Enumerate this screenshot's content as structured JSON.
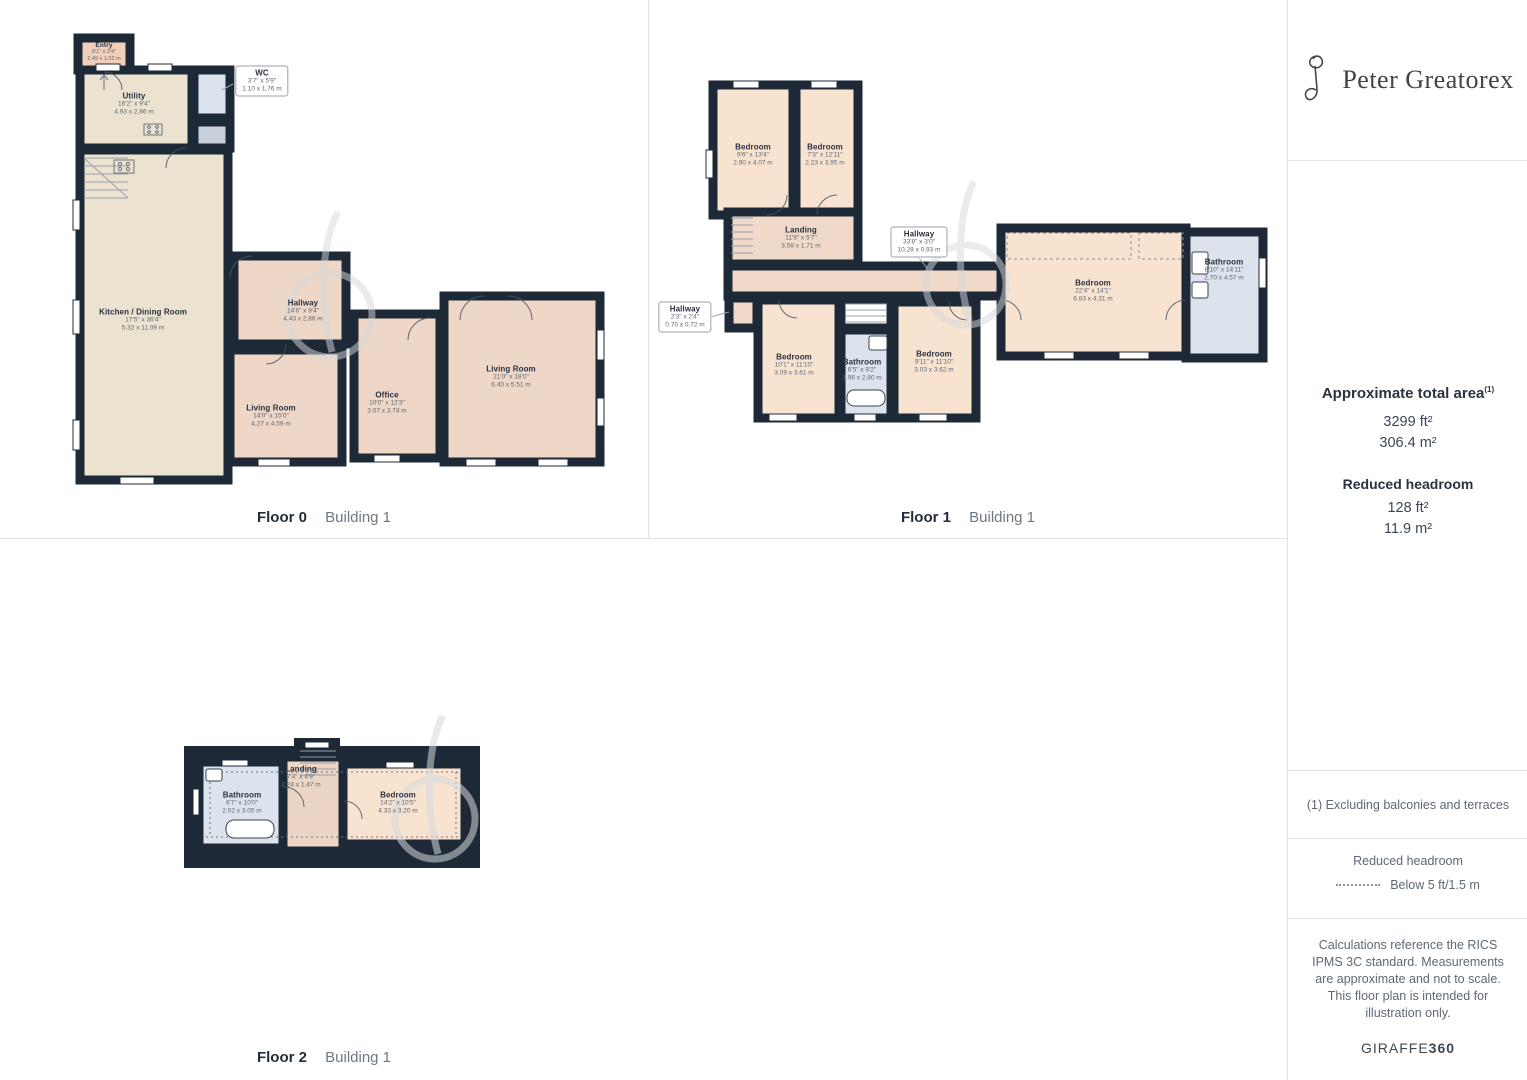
{
  "brand": {
    "name": "Peter Greatorex",
    "monogram": "PG"
  },
  "floors": [
    {
      "label": "Floor 0",
      "building": "Building 1",
      "rooms": [
        {
          "name": "Entry",
          "ft": "8'1\" x 3'4\"",
          "m": "2.49 x 1.02 m"
        },
        {
          "name": "Utility",
          "ft": "16'2\" x 9'4\"",
          "m": "4.93 x 2.86 m"
        },
        {
          "name": "WC",
          "ft": "3'7\" x 5'9\"",
          "m": "1.10 x 1.76 m"
        },
        {
          "name": "Kitchen / Dining Room",
          "ft": "17'5\" x 36'4\"",
          "m": "5.32 x 11.09 m"
        },
        {
          "name": "Hallway",
          "ft": "14'6\" x 9'4\"",
          "m": "4.43 x 2.86 m"
        },
        {
          "name": "Living Room",
          "ft": "14'0\" x 15'0\"",
          "m": "4.27 x 4.59 m"
        },
        {
          "name": "Office",
          "ft": "10'0\" x 12'3\"",
          "m": "3.07 x 3.74 m"
        },
        {
          "name": "Living Room",
          "ft": "21'0\" x 18'0\"",
          "m": "6.40 x 5.51 m"
        }
      ]
    },
    {
      "label": "Floor 1",
      "building": "Building 1",
      "rooms": [
        {
          "name": "Bedroom",
          "ft": "9'6\" x 13'4\"",
          "m": "2.90 x 4.07 m"
        },
        {
          "name": "Bedroom",
          "ft": "7'3\" x 12'11\"",
          "m": "2.23 x 3.95 m"
        },
        {
          "name": "Landing",
          "ft": "11'9\" x 5'7\"",
          "m": "3.58 x 1.71 m"
        },
        {
          "name": "Hallway",
          "ft": "33'8\" x 3'0\"",
          "m": "10.28 x 0.93 m"
        },
        {
          "name": "Hallway",
          "ft": "2'3\" x 2'4\"",
          "m": "0.70 x 0.72 m"
        },
        {
          "name": "Bedroom",
          "ft": "10'1\" x 11'10\"",
          "m": "3.09 x 3.61 m"
        },
        {
          "name": "Bathroom",
          "ft": "6'5\" x 9'2\"",
          "m": "1.96 x 2.80 m"
        },
        {
          "name": "Bedroom",
          "ft": "9'11\" x 11'10\"",
          "m": "3.03 x 3.62 m"
        },
        {
          "name": "Bedroom",
          "ft": "22'4\" x 14'1\"",
          "m": "6.83 x 4.31 m"
        },
        {
          "name": "Bathroom",
          "ft": "8'10\" x 14'11\"",
          "m": "2.70 x 4.57 m"
        }
      ]
    },
    {
      "label": "Floor 2",
      "building": "Building 1",
      "rooms": [
        {
          "name": "Bathroom",
          "ft": "6'7\" x 10'0\"",
          "m": "2.02 x 3.05 m"
        },
        {
          "name": "Landing",
          "ft": "7'4\" x 4'9\"",
          "m": "2.24 x 1.47 m"
        },
        {
          "name": "Bedroom",
          "ft": "14'2\" x 10'5\"",
          "m": "4.33 x 3.20 m"
        }
      ]
    }
  ],
  "sidebar": {
    "total_area": {
      "title": "Approximate total area",
      "superscript": "(1)",
      "ft": "3299 ft²",
      "m": "306.4 m²"
    },
    "reduced_headroom": {
      "title": "Reduced headroom",
      "ft": "128 ft²",
      "m": "11.9 m²"
    },
    "footnote": "(1) Excluding balconies and terraces",
    "legend": {
      "title": "Reduced headroom",
      "item": "Below 5 ft/1.5 m"
    },
    "disclaimer": "Calculations reference the RICS IPMS 3C standard. Measurements are approximate and not to scale. This floor plan is intended for illustration only.",
    "generator": {
      "normal": "GIRAFFE",
      "bold": "360"
    }
  },
  "colors": {
    "wall": "#1d2936",
    "kitchen_beige": "#ebe3d0",
    "room_pink": "#eed7c7",
    "room_peach": "#f8e3d0",
    "entry_pink": "#f2cfba",
    "bathroom_blue": "#dde3ed",
    "border": "#e2e2e2"
  }
}
